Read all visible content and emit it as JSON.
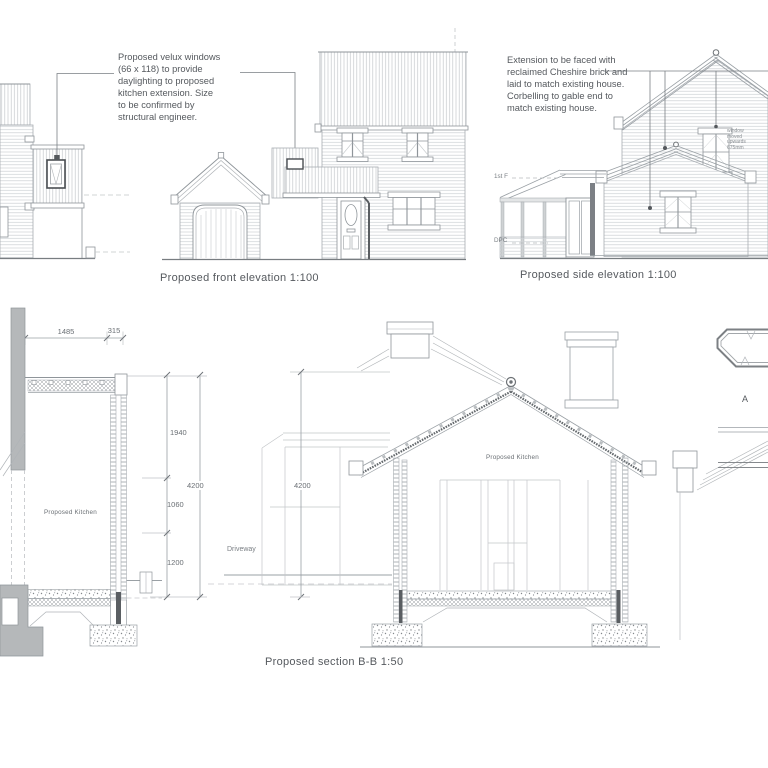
{
  "sheet": {
    "title": "Proposed elevations and section drawing sheet"
  },
  "annotations": {
    "velux_note": "Proposed velux windows\n(66 x 118) to provide\ndaylighting to proposed\nkitchen extension. Size\nto be confirmed by\nstructural engineer.",
    "brick_note": "Extension to be faced with\nreclaimed Cheshire brick and\nlaid to match existing house.\nCorbelling to gable end to\nmatch existing house.",
    "window_moved_note": "window\nmoved\nupwards\n675mm"
  },
  "captions": {
    "front_elevation": "Proposed front elevation 1:100",
    "side_elevation": "Proposed side elevation 1:100",
    "section_bb": "Proposed section B-B 1:50"
  },
  "labels": {
    "first_floor": "1st F",
    "dpc": "DPC",
    "driveway": "Driveway",
    "kitchen_left": "Proposed Kitchen",
    "kitchen_section": "Proposed Kitchen",
    "detail_a": "A"
  },
  "dimensions": {
    "width_total": "1485",
    "width_wall": "315",
    "h_upper": "1940",
    "h_mid": "1060",
    "h_lower": "1200",
    "h_total_left": "4200",
    "h_total_section": "4200"
  },
  "colors": {
    "line_light": "#a8adb2",
    "line_dark": "#787d81",
    "poche_gray": "#b5b8ba",
    "text": "#55595e",
    "background": "#ffffff"
  }
}
